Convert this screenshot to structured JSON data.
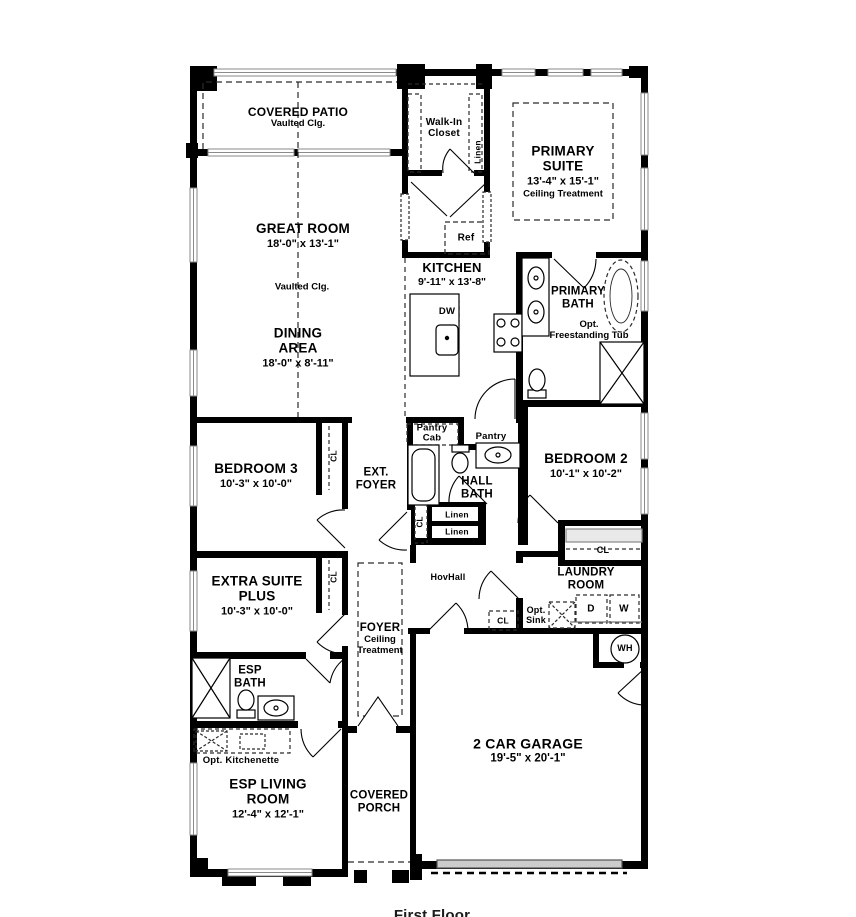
{
  "caption": "First Floor",
  "colors": {
    "wall": "#000000",
    "window_gray": "#9a9a9a",
    "garage_door_gray": "#c8c8c8",
    "background": "#ffffff"
  },
  "rooms": {
    "covered_patio": {
      "name": "COVERED PATIO",
      "note": "Vaulted Clg."
    },
    "great_room": {
      "name": "GREAT ROOM",
      "dims": "18'-0\" x 13'-1\"",
      "note": "Vaulted Clg."
    },
    "dining_area": {
      "name": "DINING AREA",
      "dims": "18'-0\" x 8'-11\""
    },
    "walk_in_closet": {
      "name": "Walk-In Closet"
    },
    "primary_suite": {
      "name": "PRIMARY SUITE",
      "dims": "13'-4\" x 15'-1\"",
      "note": "Ceiling Treatment"
    },
    "kitchen": {
      "name": "KITCHEN",
      "dims": "9'-11\" x 13'-8\""
    },
    "primary_bath": {
      "name": "PRIMARY BATH",
      "note": "Opt. Freestanding Tub"
    },
    "bedroom_3": {
      "name": "BEDROOM 3",
      "dims": "10'-3\" x 10'-0\""
    },
    "ext_foyer": {
      "name": "EXT. FOYER"
    },
    "hall_bath": {
      "name": "HALL BATH"
    },
    "bedroom_2": {
      "name": "BEDROOM 2",
      "dims": "10'-1\" x 10'-2\""
    },
    "extra_suite_plus": {
      "name": "EXTRA SUITE PLUS",
      "dims": "10'-3\" x 10'-0\""
    },
    "foyer": {
      "name": "FOYER",
      "note": "Ceiling Treatment"
    },
    "hov_hall": {
      "name": "HovHall"
    },
    "laundry_room": {
      "name": "LAUNDRY ROOM"
    },
    "esp_bath": {
      "name": "ESP BATH"
    },
    "esp_living_room": {
      "name": "ESP LIVING ROOM",
      "dims": "12'-4\" x 12'-1\""
    },
    "covered_porch": {
      "name": "COVERED PORCH"
    },
    "garage": {
      "name": "2 CAR GARAGE",
      "dims": "19'-5\" x 20'-1\""
    }
  },
  "fixtures": {
    "ref": "Ref",
    "dw": "DW",
    "dryer": "D",
    "washer": "W",
    "water_heater": "WH",
    "opt_sink": "Opt. Sink",
    "opt_kitchenette": "Opt. Kitchenette",
    "pantry": "Pantry",
    "pantry_cab": "Pantry Cab",
    "linen": "Linen",
    "closet": "CL"
  }
}
